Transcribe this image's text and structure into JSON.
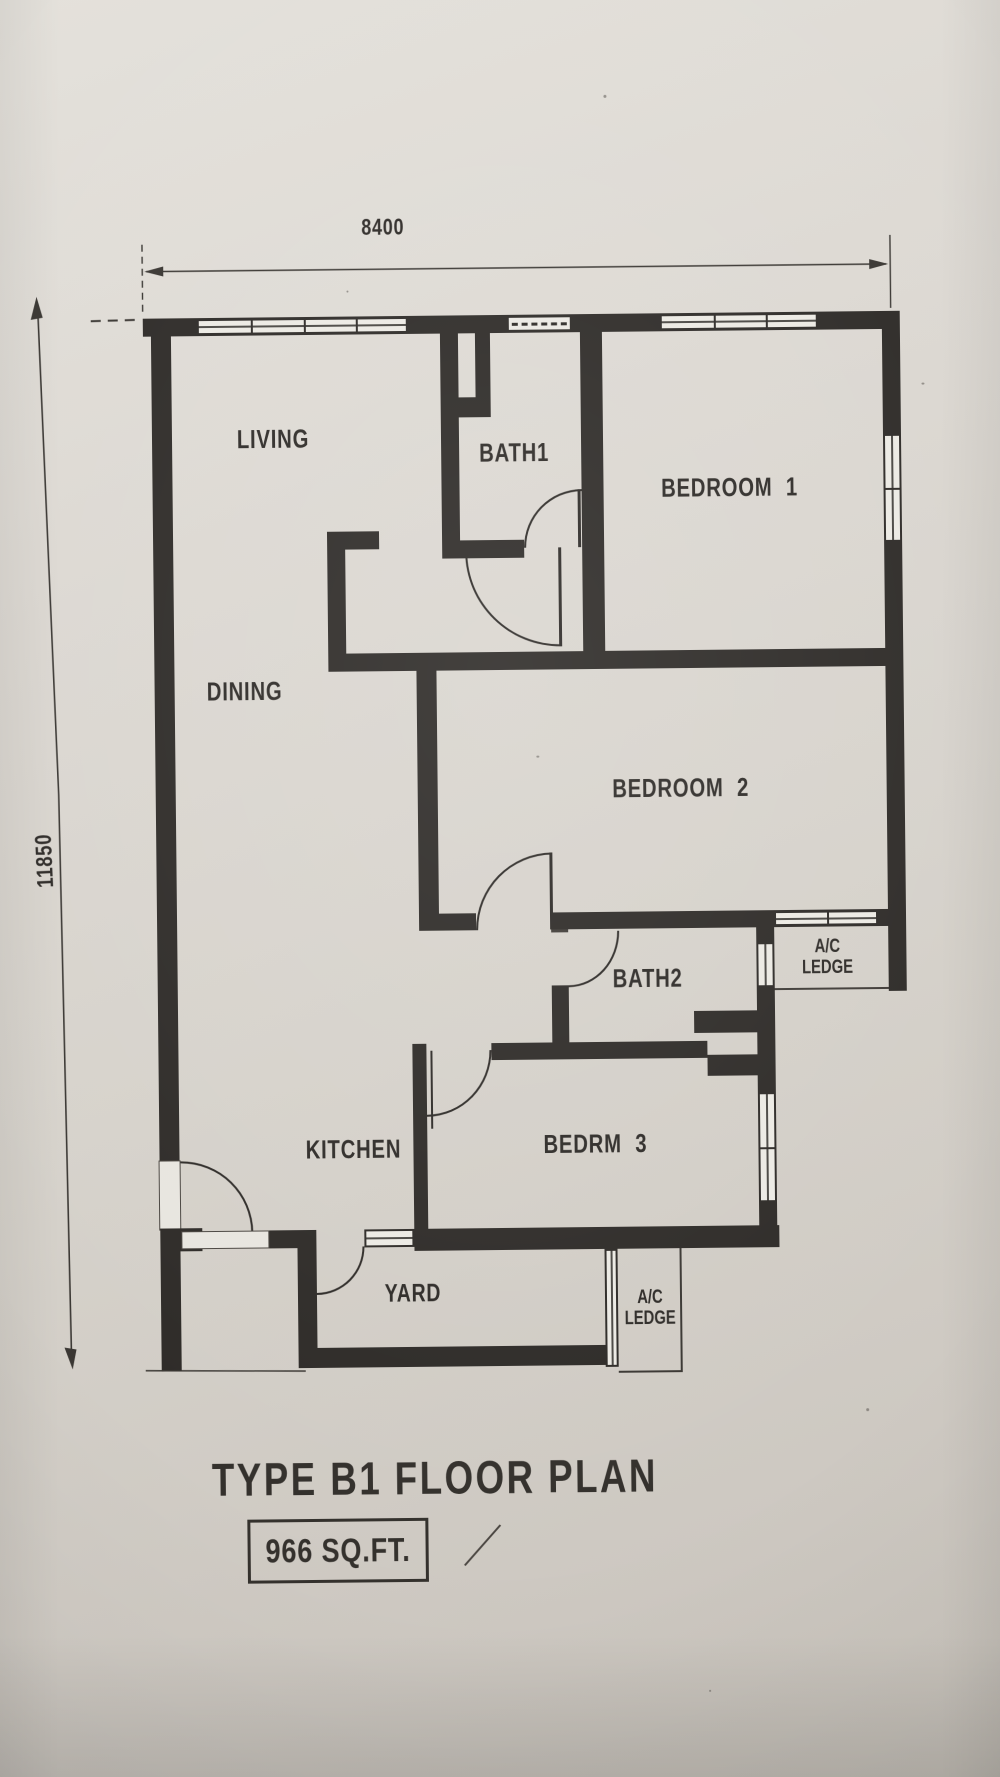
{
  "plan": {
    "title": "TYPE B1 FLOOR PLAN",
    "area_label": "966 SQ.FT.",
    "dimensions": {
      "width_mm": "8400",
      "height_mm": "11850"
    },
    "rooms": {
      "living": "LIVING",
      "bath1": "BATH1",
      "bedroom1": "BEDROOM 1",
      "dining": "DINING",
      "bedroom2": "BEDROOM 2",
      "bath2": "BATH2",
      "kitchen": "KITCHEN",
      "bedrm3": "BEDRM 3",
      "yard": "YARD",
      "ac_ledge_upper": {
        "line1": "A/C",
        "line2": "LEDGE"
      },
      "ac_ledge_lower": {
        "line1": "A/C",
        "line2": "LEDGE"
      }
    },
    "colors": {
      "paper": "#d9d5cf",
      "ink": "#2e2b28"
    }
  }
}
